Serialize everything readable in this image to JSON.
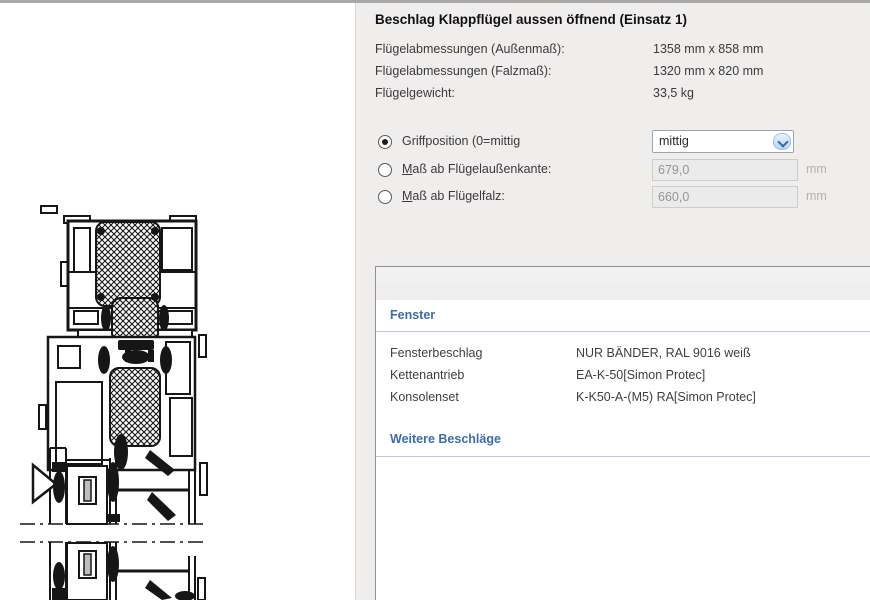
{
  "panel": {
    "title": "Beschlag Klappflügel aussen öffnend (Einsatz 1)",
    "dimensions": [
      {
        "label": "Flügelabmessungen (Außenmaß):",
        "value": "1358 mm x 858 mm"
      },
      {
        "label": "Flügelabmessungen (Falzmaß):",
        "value": "1320 mm x 820 mm"
      },
      {
        "label": "Flügelgewicht:",
        "value": "33,5 kg"
      }
    ],
    "grip": {
      "options": [
        {
          "label": "Griffposition (0=mittig",
          "selected": true
        },
        {
          "label": "Maß ab Flügelaußenkante:",
          "selected": false
        },
        {
          "label": "Maß ab Flügelfalz:",
          "selected": false
        }
      ],
      "dropdown_value": "mittig",
      "edge_value": "679,0",
      "rebate_value": "660,0",
      "unit": "mm"
    }
  },
  "table": {
    "section1_header": "Fenster",
    "rows": [
      {
        "label": "Fensterbeschlag",
        "value": "NUR BÄNDER, RAL 9016 weiß"
      },
      {
        "label": "Kettenantrieb",
        "value": "EA-K-50[Simon Protec]"
      },
      {
        "label": "Konsolenset",
        "value": "K-K50-A-(M5) RA[Simon Protec]"
      }
    ],
    "section2_header": "Weitere Beschläge"
  },
  "drawing": {
    "description": "Vertical cross-section of aluminium window profiles with hatched insulation/glazing blocks, break lines and hinge hardware"
  },
  "colors": {
    "panel_bg": "#f0eded",
    "accent_blue": "#3b6cb4",
    "section_underline": "#b9cbe2",
    "disabled_text": "#949494",
    "border_gray": "#909090"
  }
}
